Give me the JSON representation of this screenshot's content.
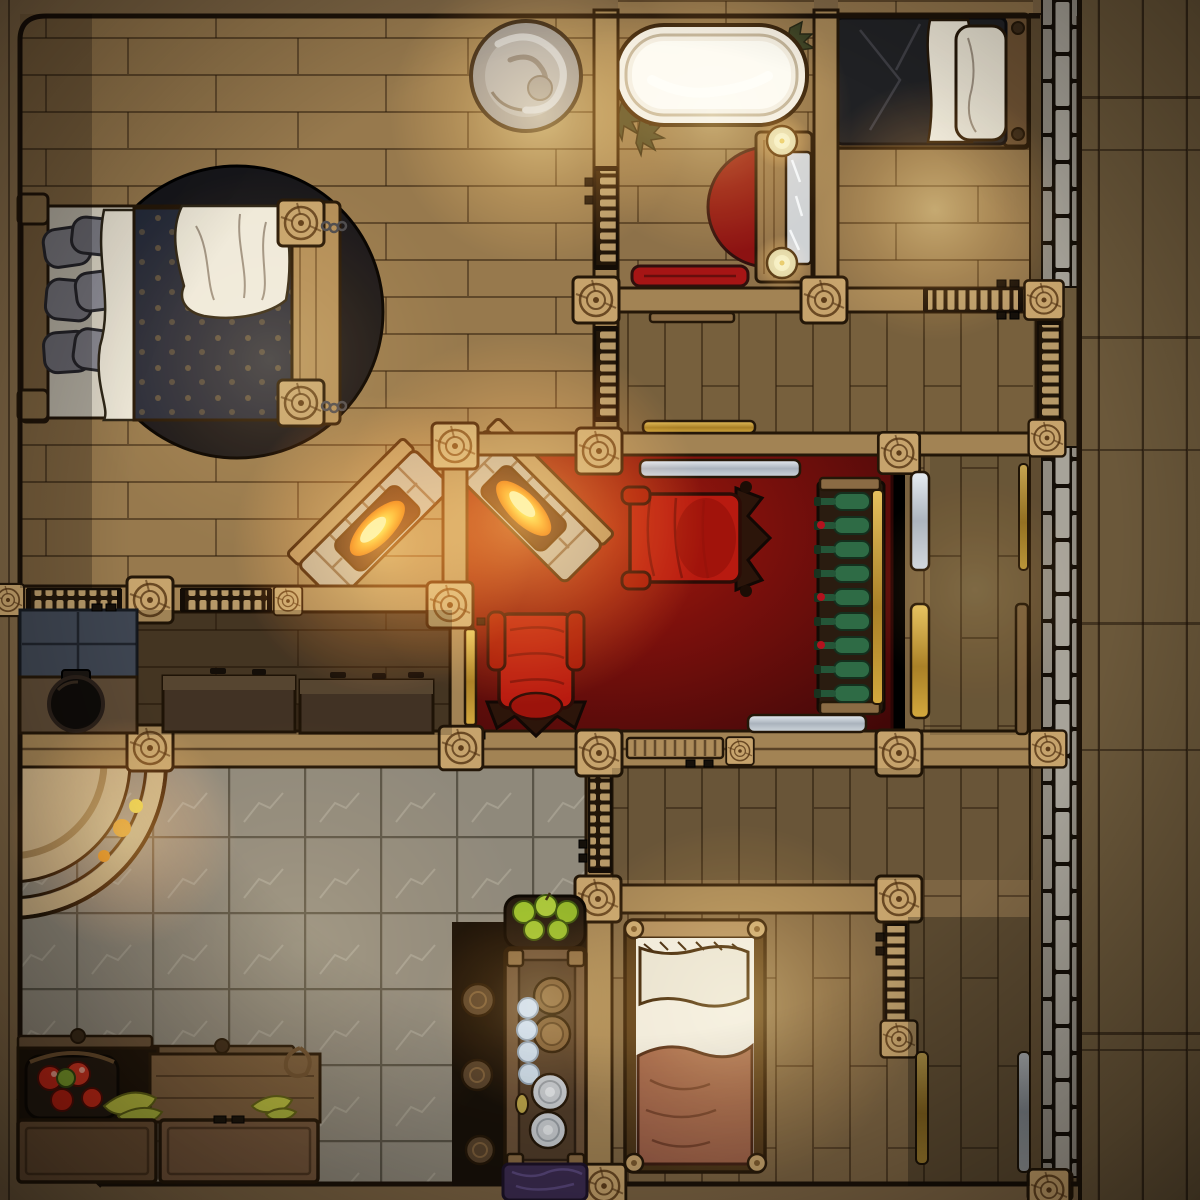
{
  "meta": {
    "map_type": "top-down fantasy battlemap",
    "setting": "inn upper floor interior",
    "grid_cell_px": 75,
    "canvas": "1200x1200"
  },
  "palette": {
    "outline": "#241708",
    "wall_beam": "#a28354",
    "wall_post": "#c6a36c",
    "floor_light": "#97794d",
    "floor_mid": "#8d7149",
    "floor_dark": "#77603d",
    "floor_darker": "#53412b",
    "deck_plank": "#6b583a",
    "border_wood": "#7d6544",
    "stone_brick_a": "#a7a399",
    "stone_brick_b": "#908b81",
    "tile_floor": "#8f897b",
    "carpet_red": "#7c100c",
    "rug_black": "#16161a",
    "tub_white": "#f2ecdf",
    "tub_inner": "#fdfaf1",
    "linen_white": "#eee8d8",
    "pillow_gray": "#8d8d95",
    "blanket_navy": "#252b3a",
    "blanket_black": "#202124",
    "blanket_brown": "#9c5f48",
    "towel_red": "#a61515",
    "vanity_rug_red": "#8c1212",
    "chair_red": "#b81a10",
    "chair_wood": "#2c150a",
    "bottle_green": "#2e6b45",
    "gold": "#c9a23c",
    "silver": "#bfc7cf",
    "fire_core": "#ffe896",
    "hearth_stone": "#b3a489",
    "statue_gray": "#8f8f8d",
    "slate": "#3e4551",
    "counter_dark": "#5d4a35",
    "cauldron_black": "#0e0b08",
    "apple_red": "#c22616",
    "apple_green": "#9cbf2e",
    "banana": "#b8bd3e",
    "basket_brown": "#7a5a36",
    "egg_blue": "#ccdce8",
    "plate_silver": "#c9cdd1",
    "cloth_purple": "#3c2c52",
    "ladder_wood": "#b79968"
  },
  "rooms": [
    {
      "id": "master-bedroom",
      "floor": "wood-planks",
      "features": [
        "round-black-rug",
        "double-bed-navy-blanket",
        "stone-gray-pillows",
        "footboard-bench"
      ]
    },
    {
      "id": "bathroom",
      "floor": "wood-planks",
      "features": [
        "clawfoot-bathtub",
        "vanity-with-mirror",
        "two-candles",
        "red-half-rug",
        "red-towel",
        "corner-plants",
        "wall-ladder-shutters"
      ]
    },
    {
      "id": "ne-bedroom",
      "floor": "wood-planks",
      "features": [
        "single-bed-black-blanket",
        "white-pillow"
      ]
    },
    {
      "id": "sitting-room",
      "floor": "red-carpet",
      "features": [
        "armchair-facing-west",
        "armchair-facing-north",
        "wine-rack-9-bottles",
        "silver-bench-north",
        "silver-bench-south",
        "corner-fireplace",
        "gold-door-west"
      ]
    },
    {
      "id": "west-hall",
      "floor": "wood-planks",
      "features": [
        "stone-statue",
        "corner-fireplace"
      ]
    },
    {
      "id": "kitchen",
      "floor": "stone-tiles",
      "features": [
        "round-hearth-with-embers",
        "slate-stove",
        "cauldron-counter",
        "long-dark-counter",
        "produce-bins",
        "fruit-crates"
      ]
    },
    {
      "id": "pantry-nook",
      "floor": "dark-wood",
      "features": [
        "food-hutch",
        "green-apple-basket",
        "plate-stacks",
        "egg-bowl",
        "rope-sacks",
        "purple-cloth"
      ]
    },
    {
      "id": "south-bedroom",
      "floor": "wood-planks",
      "features": [
        "single-bed-brown-blanket",
        "wall-ladder-shutter"
      ]
    },
    {
      "id": "east-gallery",
      "floor": "wood-planks",
      "features": [
        "silver-bench",
        "gold-bench",
        "wood-bench",
        "stone-outer-wall",
        "plank-deck"
      ]
    }
  ],
  "props": {
    "wine_bottles_count": 9,
    "red_apples_count": 5,
    "green_apples_count": 5,
    "banana_bunches_count": 2,
    "plate_stacks_count": 2,
    "eggs_count": 4,
    "candles_count": 2,
    "fire_sources_count": 3,
    "window_shutters_count": 7,
    "gold_doors_count": 1,
    "beds_count": 3
  }
}
